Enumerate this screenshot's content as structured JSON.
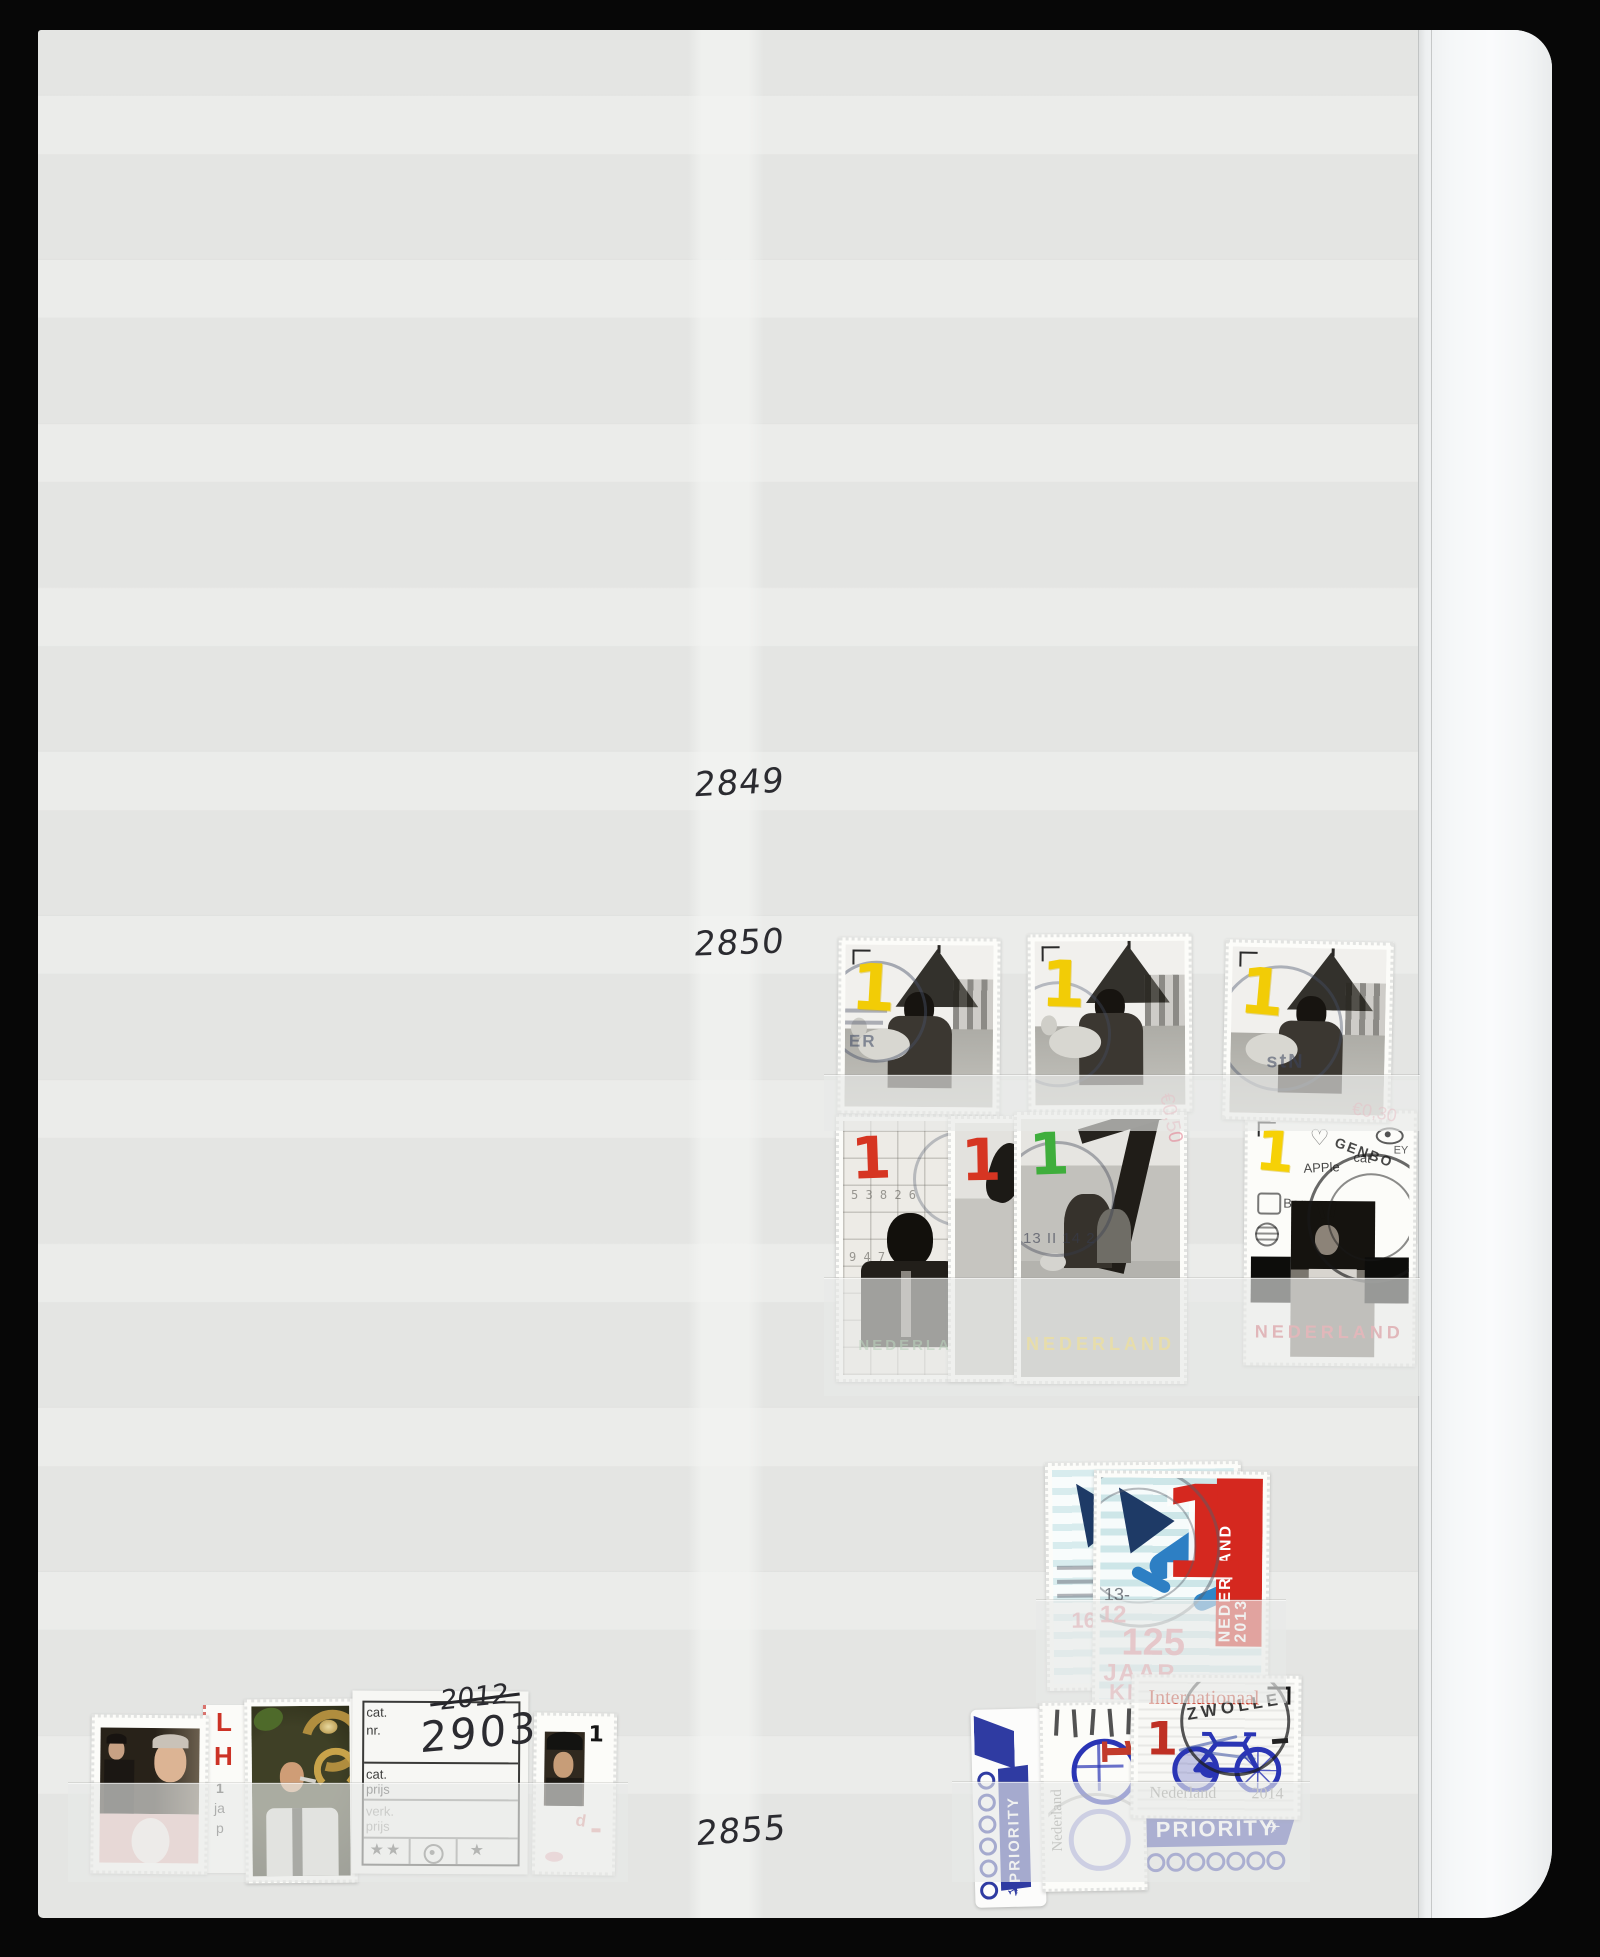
{
  "hand": {
    "n2849": "2849",
    "n2850": "2850",
    "n2855": "2855",
    "year": "2012",
    "number": "2903"
  },
  "marks": {
    "m1": "€0,50",
    "m2": "€0,30"
  },
  "childlamb": {
    "den": "1",
    "pm1": "ER",
    "pm3": "stN"
  },
  "gridboy": {
    "den": "1",
    "country": "NEDERLAND",
    "digits1": "5 3 8 2 6",
    "digits2": "9 4 7 1"
  },
  "sliver": {
    "den": "1"
  },
  "treekids": {
    "den": "1",
    "country": "NEDERLAND",
    "cancel": "13 II 14 2"
  },
  "drawings": {
    "den": "1",
    "country": "NEDERLAND",
    "apple": "APPle",
    "cat": "cat",
    "eye": "EY",
    "bag": "Bag",
    "pm": "GENBO"
  },
  "knzb": {
    "den": "1",
    "band": "NEDERLAND 2013",
    "t12": "12",
    "t125": "125",
    "tjaar": "JAAR",
    "tknz": "KNZ",
    "p16": "16",
    "p13": "13-"
  },
  "bike": {
    "service": "Internationaal",
    "den": "1",
    "country": "Nederland",
    "year": "2014",
    "pm": "ZWOLLE"
  },
  "bikeside": {
    "country": "Nederland",
    "den": "1"
  },
  "priority": {
    "label": "PRIORITY",
    "plane": "✈"
  },
  "lhcard": {
    "l": "L",
    "h": "H",
    "s1": "1",
    "s2": "ja",
    "s3": "p"
  },
  "capman": {
    "den": "1",
    "mark": "d"
  },
  "card": {
    "cat": "cat.",
    "nr": "nr.",
    "prijs": "prijs",
    "verk": "verk.",
    "stars": "★★",
    "star": "★"
  }
}
